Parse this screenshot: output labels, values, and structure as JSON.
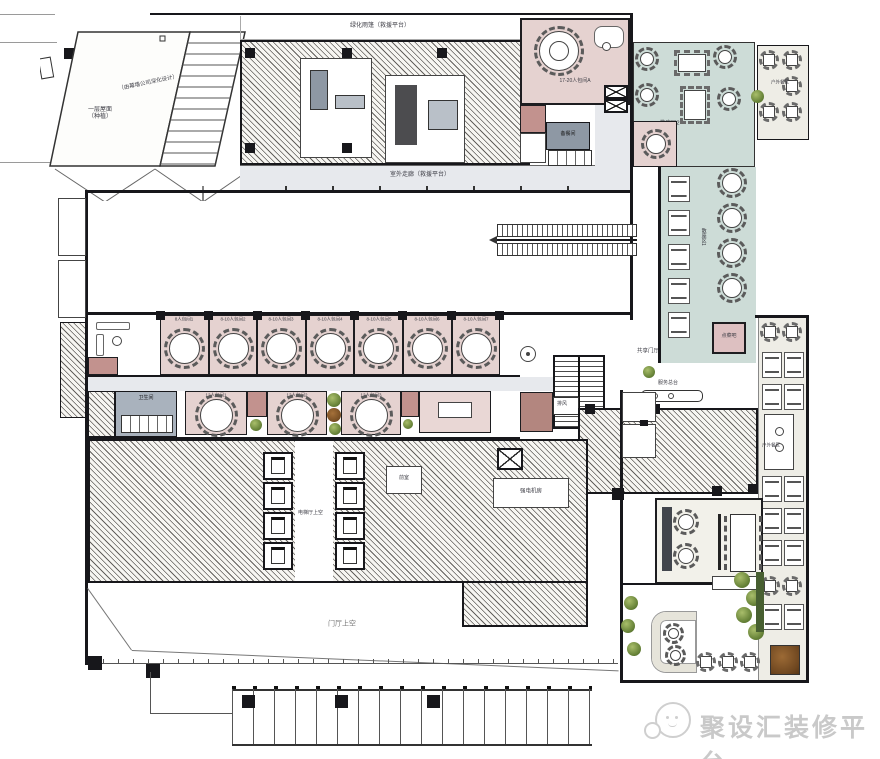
{
  "areas": {
    "roof_line1": "一层屋面",
    "roof_line2": "（种植）",
    "curtain_note": "（由幕墙公司深化设计）",
    "green_canopy": "绿化雨篷（救援平台）",
    "outdoor_corridor": "室外走廊（救援平台）",
    "vip_room": "17-20人包间A",
    "open_dining_2": "散座区2",
    "open_dining_1": "散座区1",
    "outdoor_dining_ne": "户外餐区",
    "outdoor_dining_e": "户外餐区",
    "order_bar": "点菜吧",
    "shared_lobby": "共享门厅",
    "service_desk": "服务总台",
    "exhaust": "排风",
    "pantry": "备餐间",
    "restroom": "卫生间",
    "elevator_hall_void": "电梯厅上空",
    "front_chamber": "前室",
    "electrical_room": "强电机房",
    "lobby_void": "门厅上空"
  },
  "private_rooms_row1": [
    "8人包间1",
    "8-10人包间2",
    "8-10人包间3",
    "8-10人包间4",
    "8-10人包间5",
    "8-10人包间6",
    "8-10人包间7"
  ],
  "private_rooms_row2": [
    "12人包间1",
    "12人包间2",
    "12人包间3"
  ],
  "watermark": {
    "brand": "聚设汇装修平台"
  }
}
